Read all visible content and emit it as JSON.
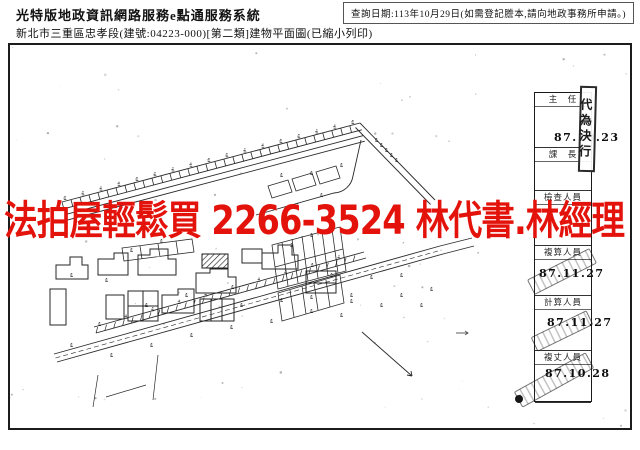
{
  "header": {
    "system_title": "光特版地政資訊網路服務e點通服務系統",
    "document_title": "新北市三重區忠孝段(建號:04223-000)[第二類]建物平面圖(已縮小列印)",
    "query_notice": "查詢日期:113年10月29日(如需登記謄本,請向地政事務所申請。)"
  },
  "ad_banner": {
    "text": "法拍屋輕鬆買 2266-3524 林代書.林經理",
    "color": "#e3120b"
  },
  "signature_block": {
    "delegate_stamp": "代為決行",
    "cells": [
      {
        "label": "主　任",
        "date": "87.10.23"
      },
      {
        "label": "課　長",
        "date": ""
      },
      {
        "label": "檢查人員",
        "date": ""
      },
      {
        "label": "複算人員",
        "date": "87.11.27"
      },
      {
        "label": "計算人員",
        "date": "87.11.27"
      },
      {
        "label": "複丈人員",
        "date": "87.10.28"
      }
    ]
  },
  "colors": {
    "ink": "#1a1a1a",
    "paper": "#ffffff"
  }
}
